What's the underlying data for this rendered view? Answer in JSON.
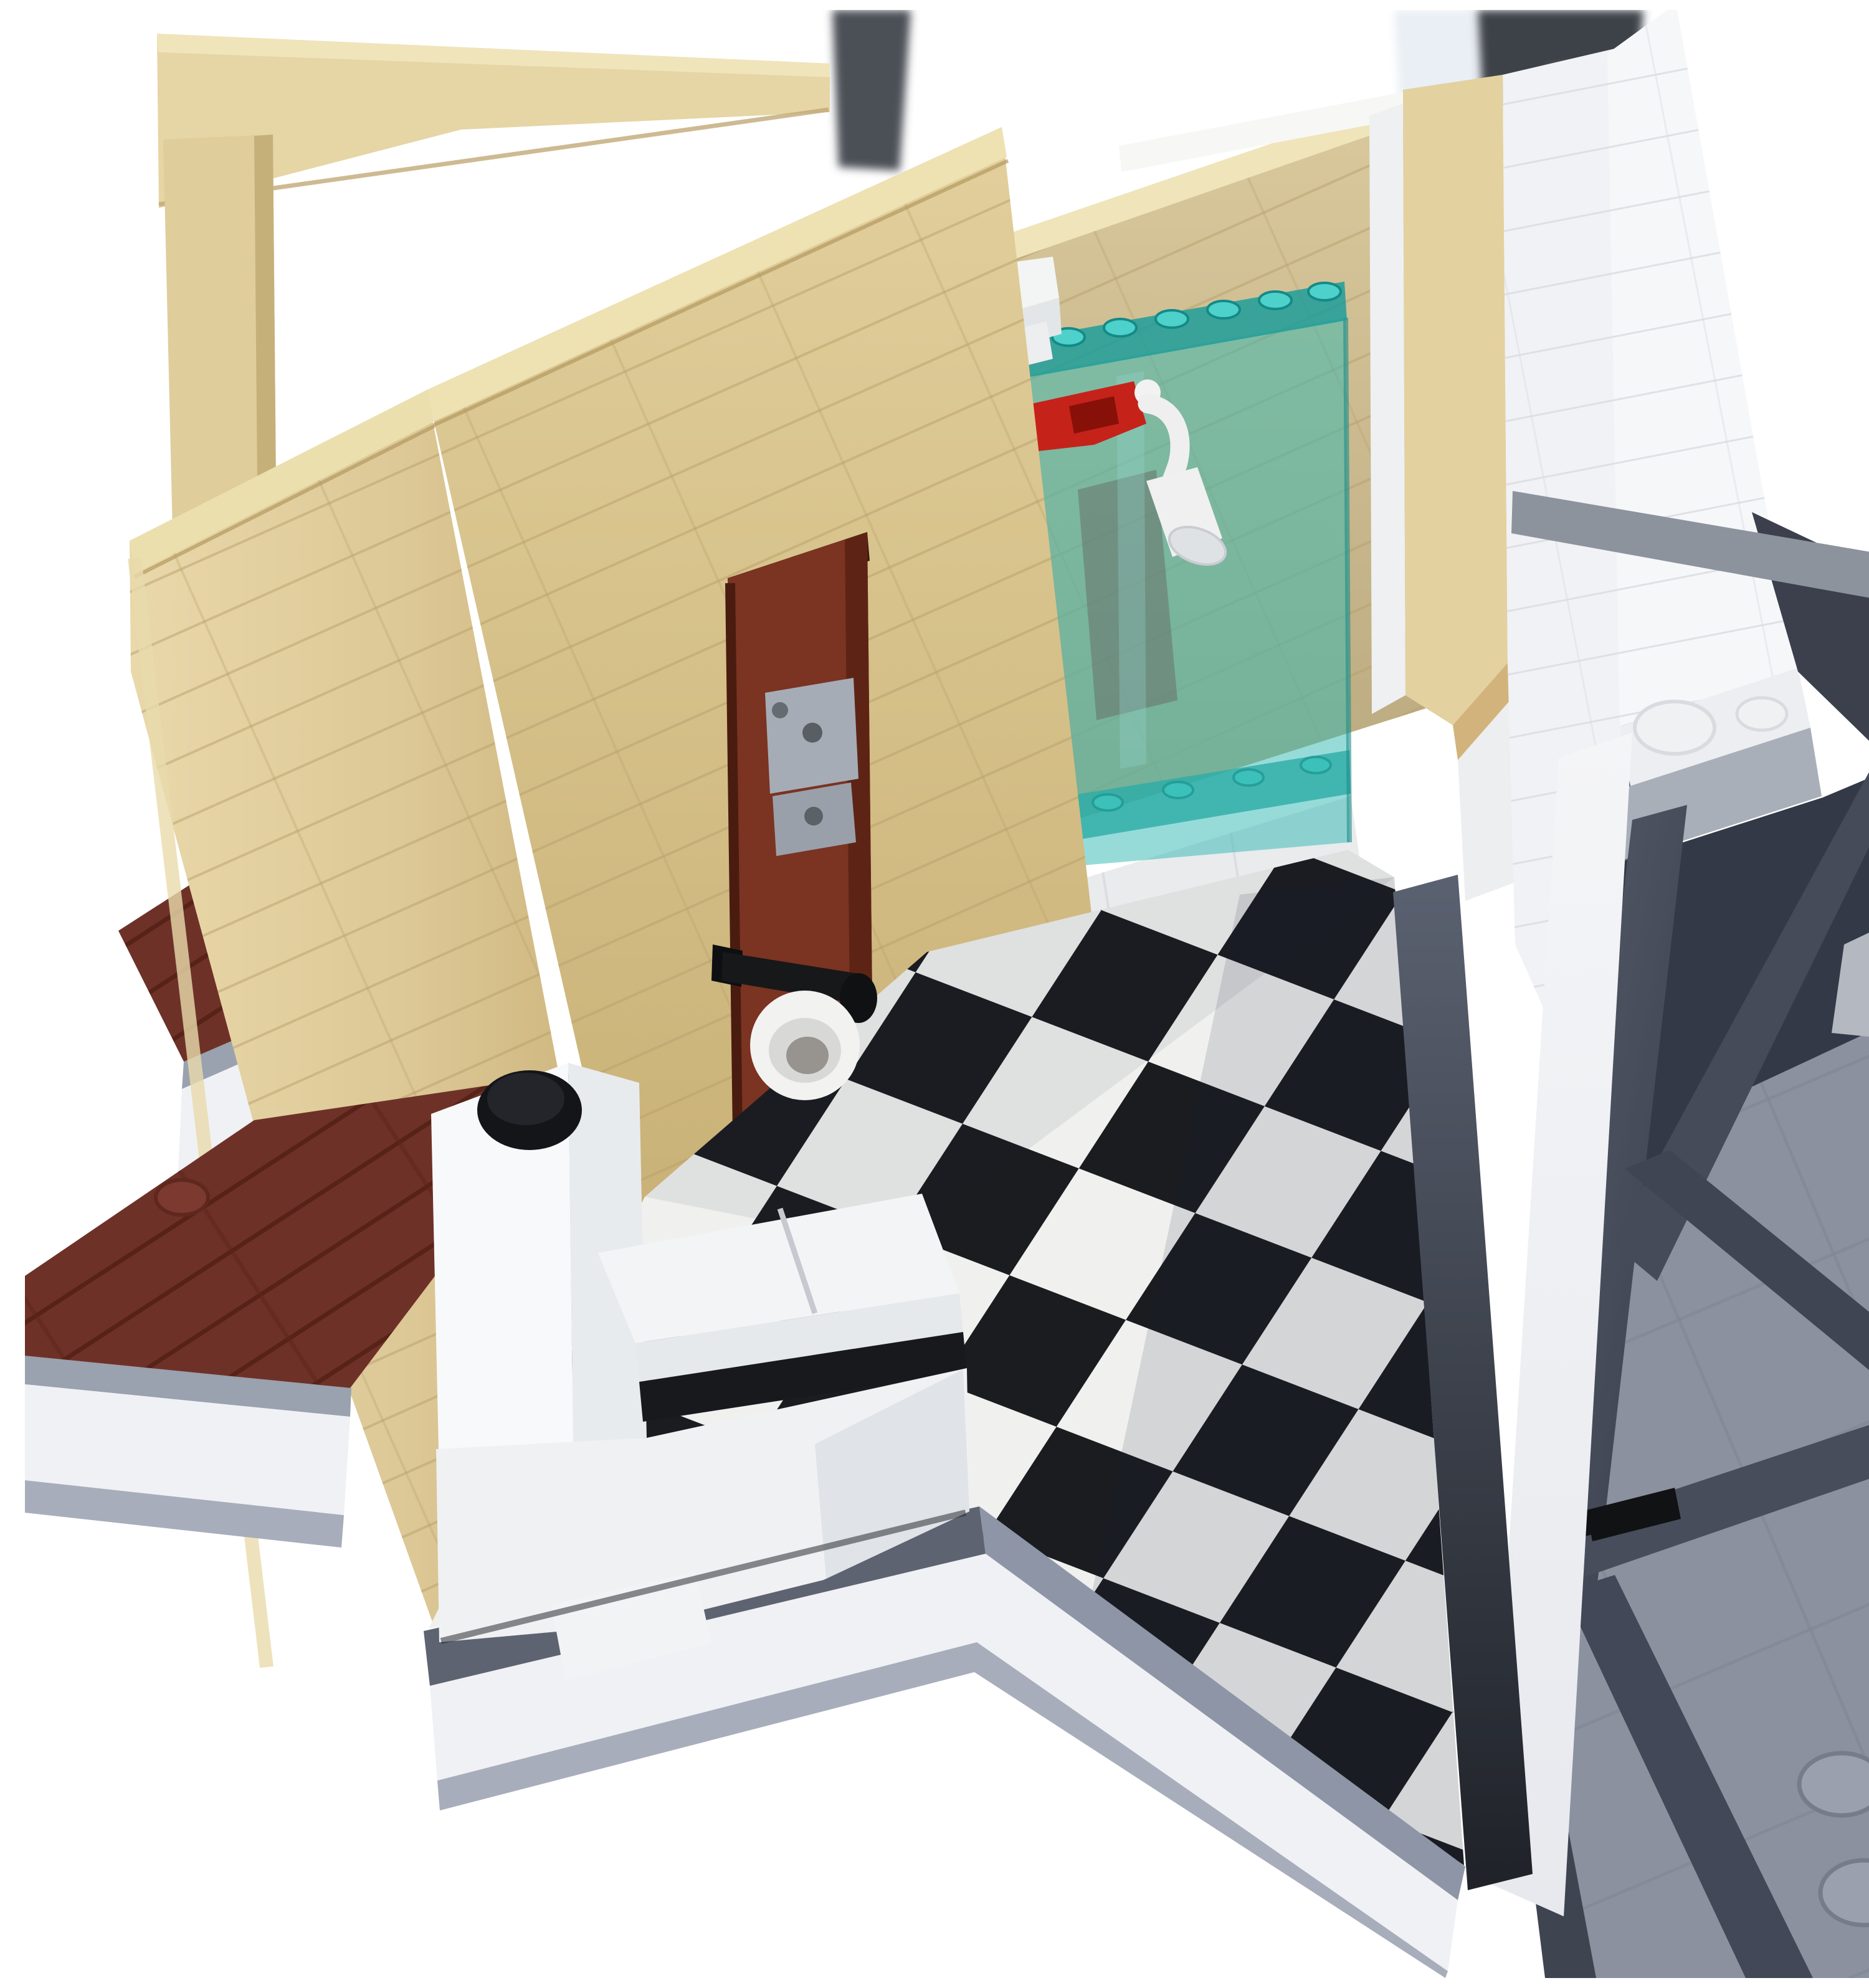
{
  "scene": {
    "title": "Photograph of a LEGO modular building bathroom interior cutaway on a white background",
    "description": "Cutaway LEGO bathroom: tan brick walls with a dark brown door on grey hinges, black and white checkerboard tile floor, white brick toilet with black flush knob, black toilet-roll holder with white paper roll, transparent teal curved shower enclosure with studded rails, red mixer valve and white shower head over a white tiled shower base, reddish-brown plank deck outside left, white base wall with grey cap, and on the right a white outer wall crossed by a grey tile bar above a dark grey support truss standing on a studded grey baseplate.",
    "photo_style": "product-style cutout, blurred room fixtures visible at top edge",
    "objects": [
      {
        "name": "tan-lintel-beam",
        "description": "horizontal tan brick beam, top left",
        "color": "#e6d5a5"
      },
      {
        "name": "tan-corner-post",
        "description": "vertical tan post under beam",
        "color": "#dfcd9c"
      },
      {
        "name": "tan-side-wall",
        "description": "near edge-on tan brick wall, left foreground",
        "color": "#dcc795"
      },
      {
        "name": "tan-door-wall",
        "description": "diagonal tan wall containing doorway",
        "color": "#d8c28c"
      },
      {
        "name": "tan-back-wall",
        "description": "tan wall behind shower",
        "color": "#d2c094"
      },
      {
        "name": "tan-end-column",
        "description": "tan wall end cap column at right of back wall",
        "color": "#e3d1a0"
      },
      {
        "name": "door",
        "description": "dark reddish-brown door in doorway",
        "color": "#7b3322"
      },
      {
        "name": "door-hinges",
        "description": "light grey LEGO hinge pieces",
        "color": "#a6acb5",
        "count": 2
      },
      {
        "name": "toilet-roll-holder",
        "description": "black bar holder on wall",
        "color": "#17181a"
      },
      {
        "name": "toilet-paper-roll",
        "description": "white cylinder roll",
        "color": "#f2f2f1"
      },
      {
        "name": "toilet",
        "description": "white brick-built toilet: tank, seat tiles, bowl base",
        "color": "#f4f5f6"
      },
      {
        "name": "toilet-flush-knob",
        "description": "round black knob on tank",
        "color": "#141519"
      },
      {
        "name": "toilet-plinth",
        "description": "dark grey strip under toilet",
        "color": "#5d6370"
      },
      {
        "name": "checkerboard-floor",
        "description": "black and white tiled bathroom floor in perspective",
        "colors": [
          "#1b1c1f",
          "#f0f0ee"
        ]
      },
      {
        "name": "shower-base",
        "description": "white tiled quarter-round shower platform",
        "color": "#e9ebed"
      },
      {
        "name": "shower-enclosure",
        "description": "transparent teal curved glass with studded rails",
        "color": "#2fb8b2",
        "top_rail_studs": 7,
        "bottom_rail_studs": 6,
        "curved_rim_studs": 3
      },
      {
        "name": "shower-valve",
        "description": "red mixer valve brick",
        "color": "#c5221a"
      },
      {
        "name": "shower-head",
        "description": "white shower arm and cone head",
        "color": "#f0f0f0"
      },
      {
        "name": "deck",
        "description": "reddish-brown plank deck outside wall, one stud",
        "color": "#6e3128",
        "studs": 1
      },
      {
        "name": "base-wall",
        "description": "white brick base band with blue-grey cap and lower band",
        "colors": [
          "#9aa1af",
          "#eff1f4",
          "#a7adbb"
        ]
      },
      {
        "name": "interior-white-wall",
        "description": "white wall right of shower",
        "color": "#f1f2f5"
      },
      {
        "name": "outer-white-wall",
        "description": "tall white outer wall, right, with two side studs at its foot",
        "color": "#f6f7f9",
        "side_studs": 2
      },
      {
        "name": "grey-tile-bar",
        "description": "grey tile course crossing right walls",
        "color": "#8d939d"
      },
      {
        "name": "support-truss",
        "description": "dark grey girder truss structure, right",
        "color": "#3b404c"
      },
      {
        "name": "baseplate",
        "description": "grey studded baseplate under truss, bottom right",
        "color": "#8b919f",
        "visible_studs": 2
      },
      {
        "name": "axle-connector",
        "description": "small black connector on truss",
        "color": "#101214"
      },
      {
        "name": "background-fixtures",
        "description": "blurred dark grey fixtures at top edge of photo",
        "color": "#464b51"
      }
    ],
    "palette": {
      "tan": "#dfcb97",
      "tan_light": "#efe3b8",
      "tan_shadow": "#c8b17b",
      "door_brown": "#7b3322",
      "hinge_grey": "#a6acb5",
      "glass_teal": "#2fb8b2",
      "glass_rail": "#1f9e9a",
      "valve_red": "#c5221a",
      "white_brick": "#f2f3f5",
      "checker_black": "#1b1c1f",
      "checker_white": "#f0f0ee",
      "deck_brown": "#6e3128",
      "cap_grey": "#9aa1af",
      "band_grey": "#a7adbb",
      "truss_dark": "#3b404c",
      "truss_member": "#4a505e",
      "baseplate_grey": "#8b919f",
      "black": "#141517",
      "background": "#ffffff"
    }
  }
}
